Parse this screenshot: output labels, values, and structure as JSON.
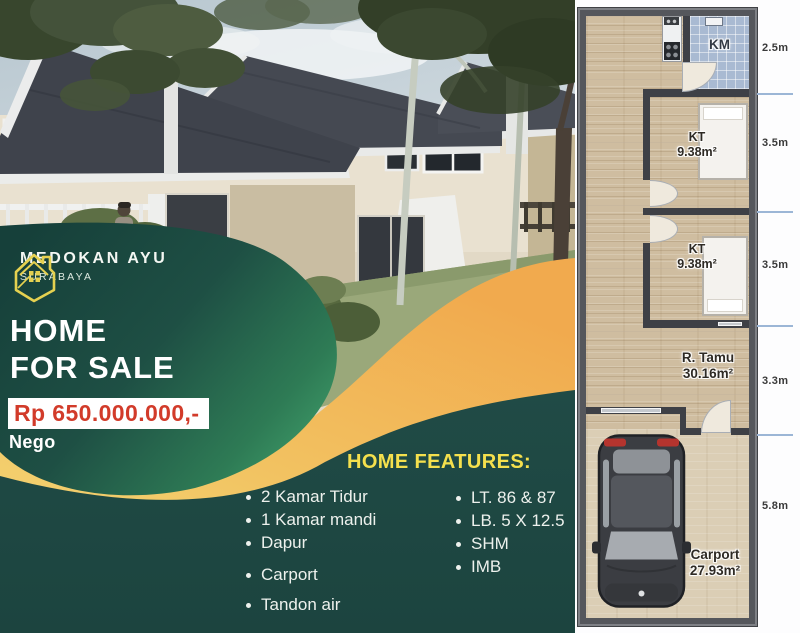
{
  "poster": {
    "logo": {
      "name": "MEDOKAN AYU",
      "subtitle": "SURABAYA"
    },
    "title": {
      "line1": "HOME",
      "line2": "FOR SALE"
    },
    "price": "Rp 650.000.000,-",
    "negotiable": "Nego",
    "features": {
      "heading": "HOME FEATURES:",
      "column1": [
        "2 Kamar Tidur",
        "1 Kamar mandi",
        "Dapur",
        "Carport",
        "Tandon air"
      ],
      "column2": [
        "LT. 86 & 87",
        "LB. 5 X 12.5",
        "SHM",
        "IMB"
      ]
    }
  },
  "floorplan": {
    "rooms": {
      "bathroom": {
        "label": "KM"
      },
      "bedroom1": {
        "label": "KT",
        "area": "9.38m²"
      },
      "bedroom2": {
        "label": "KT",
        "area": "9.38m²"
      },
      "living_room": {
        "label": "R. Tamu",
        "area": "30.16m²"
      },
      "carport": {
        "label": "Carport",
        "area": "27.93m²"
      }
    },
    "dimensions": [
      "2.5m",
      "3.5m",
      "3.5m",
      "3.3m",
      "5.8m"
    ]
  },
  "colors": {
    "brand_green": "#2e7b55",
    "brand_dark_teal": "#1e4944",
    "accent_yellow": "#f2d36a",
    "accent_orange": "#f0ad52",
    "price_red": "#d23b2a",
    "logo_yellow": "#e5d150",
    "heading_yellow": "#f5e04d"
  }
}
